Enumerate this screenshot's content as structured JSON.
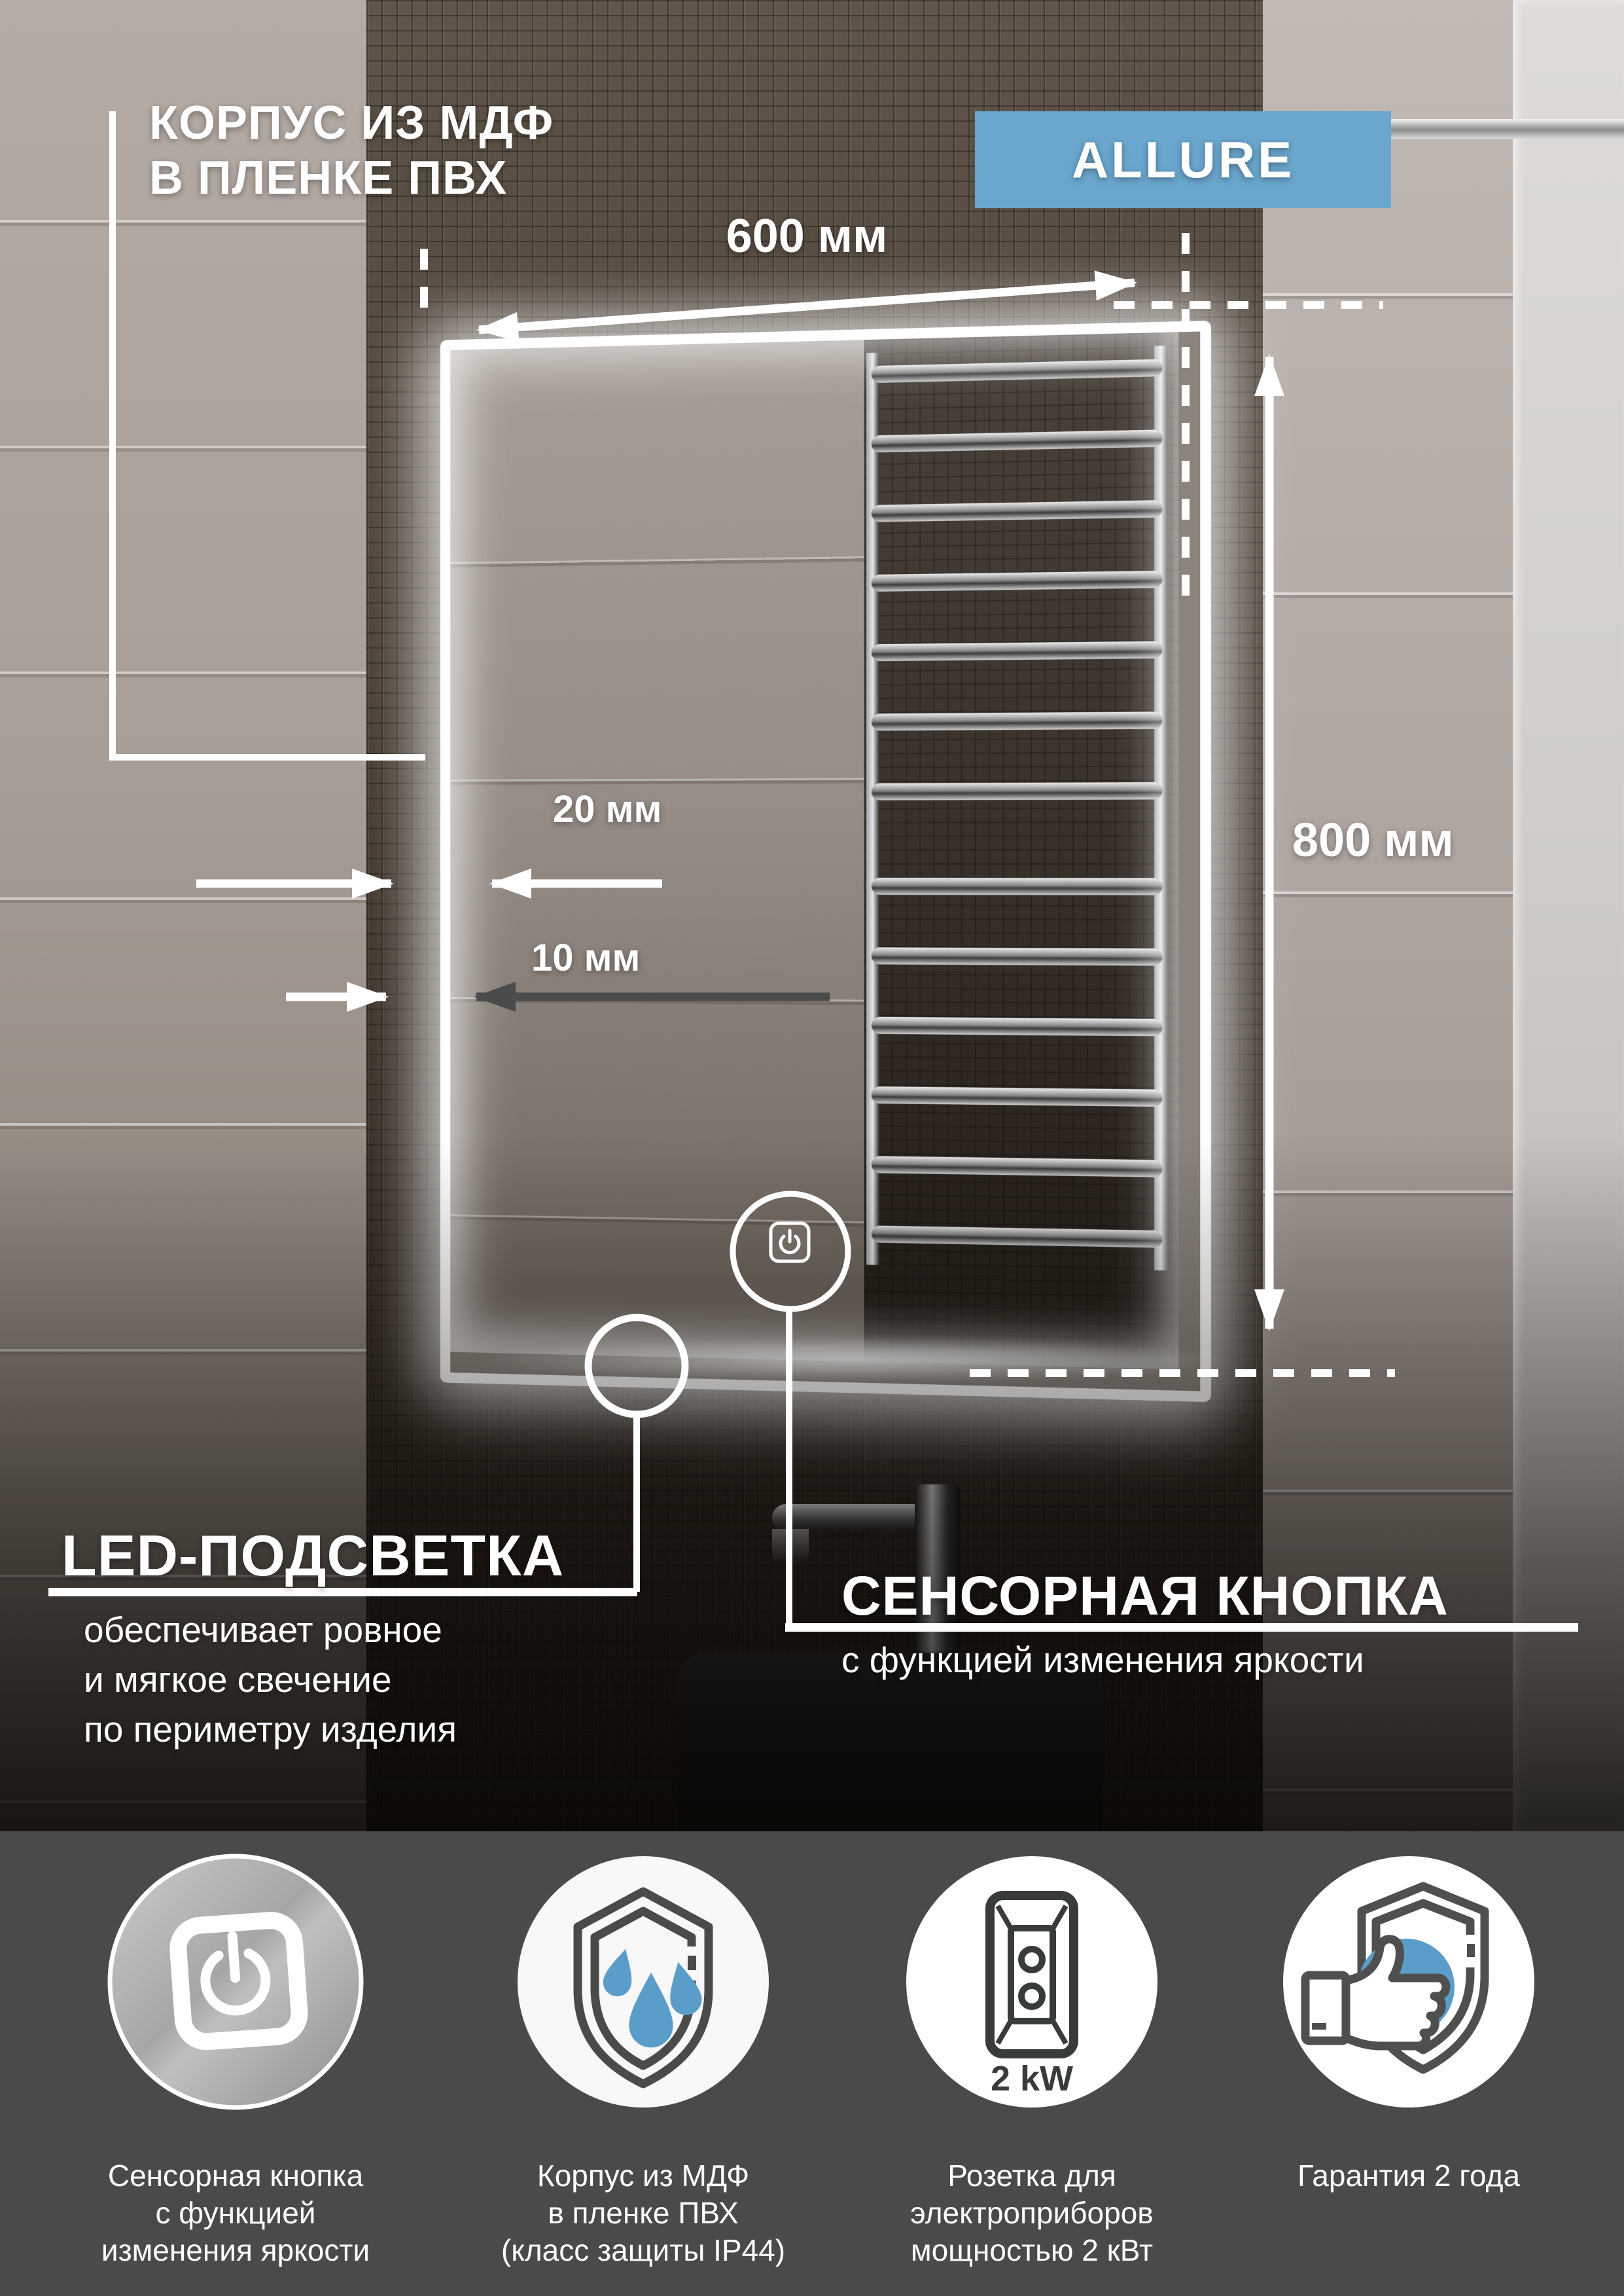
{
  "page": {
    "title_line1": "КОРПУС ИЗ МДФ",
    "title_line2": "В ПЛЕНКЕ ПВХ"
  },
  "badge": {
    "label": "ALLURE"
  },
  "dimensions": {
    "width": "600 мм",
    "height": "800 мм",
    "led_width": "20 мм",
    "glass_offset": "10 мм"
  },
  "led_callout": {
    "title": "LED-ПОДСВЕТКА",
    "line1": "обеспечивает ровное",
    "line2": "и мягкое свечение",
    "line3": "по периметру изделия"
  },
  "touch_callout": {
    "title": "СЕНСОРНАЯ КНОПКА",
    "subtitle": "с функцией изменения яркости"
  },
  "socket_power": "2 kW",
  "features": [
    {
      "caption1": "Сенсорная кнопка",
      "caption2": "с функцией",
      "caption3": "изменения яркости"
    },
    {
      "caption1": "Корпус из МДФ",
      "caption2": "в пленке ПВХ",
      "caption3": "(класс защиты IP44)"
    },
    {
      "caption1": "Розетка для",
      "caption2": "электроприборов",
      "caption3": "мощностью 2 кВт"
    },
    {
      "caption1": "Гарантия 2 года",
      "caption2": "",
      "caption3": ""
    }
  ],
  "colors": {
    "accent_blue": "#6aa6cd",
    "drop_blue": "#5b9dc9",
    "footer_bg": "#4b4949",
    "annotation_dark": "#4b4b4b"
  }
}
